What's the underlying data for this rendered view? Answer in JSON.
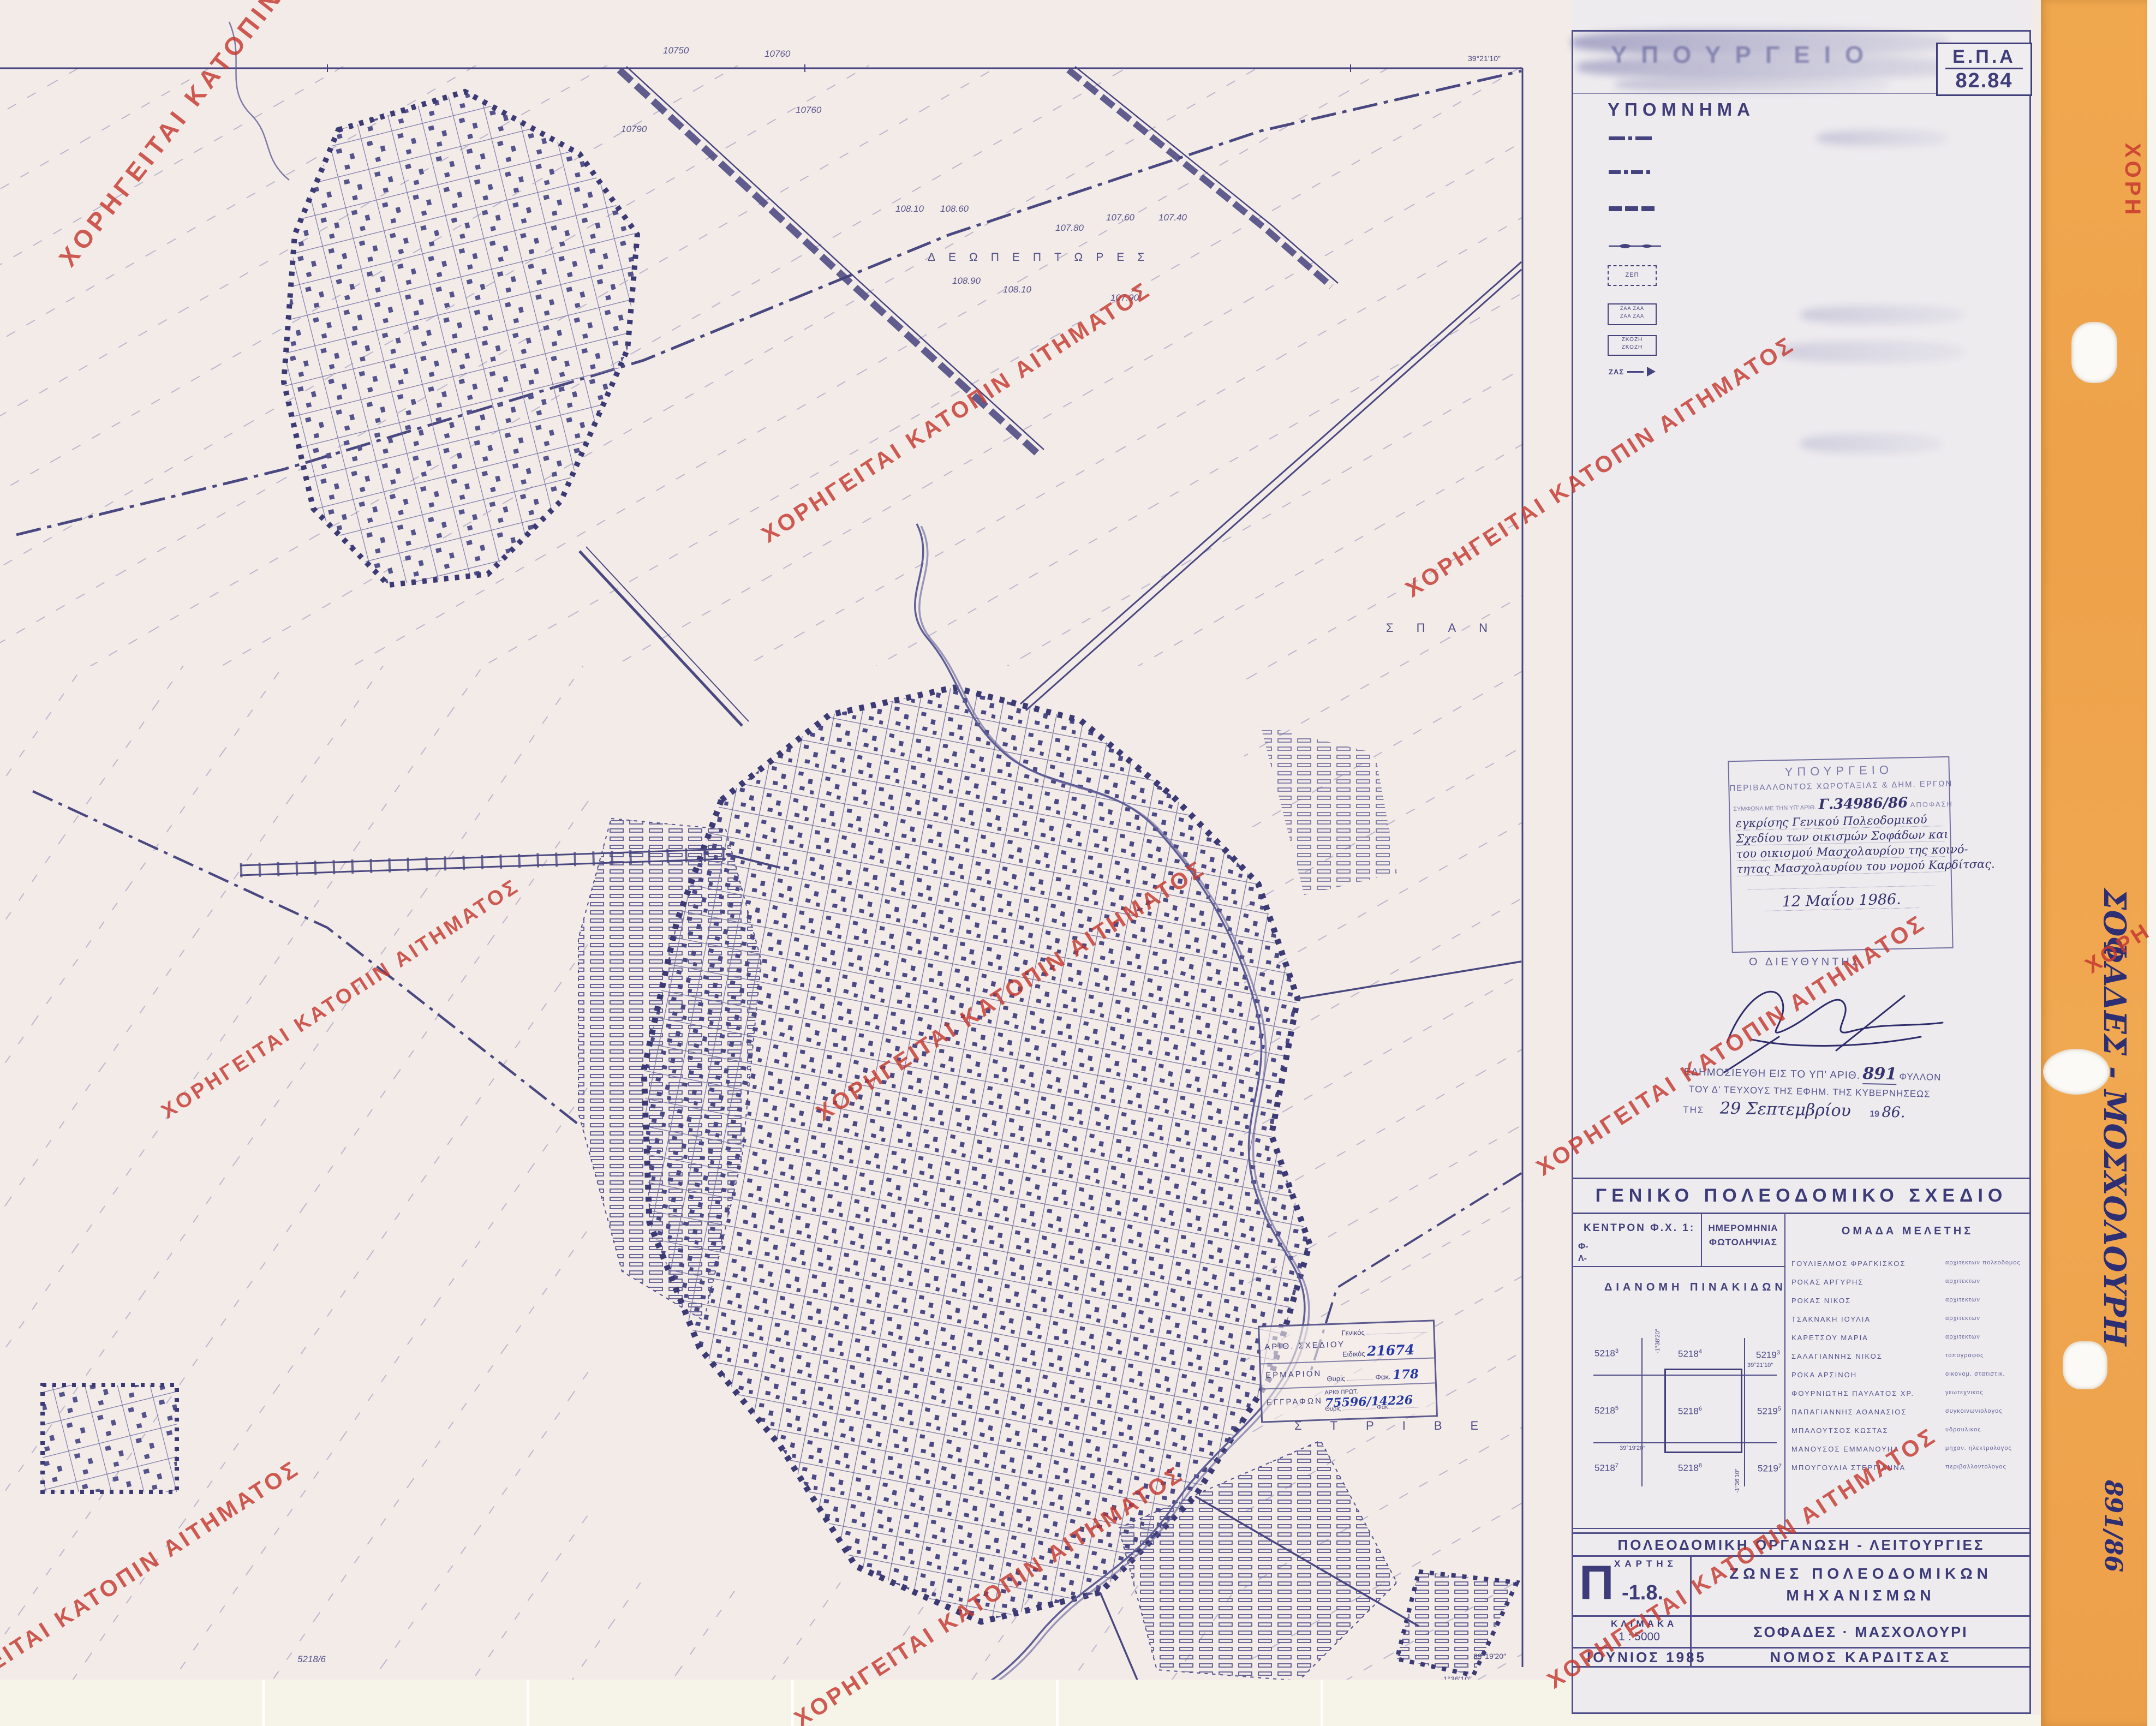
{
  "watermark": {
    "text": "ΧΟΡΗΓΕΙΤΑΙ ΚΑΤΟΠΙΝ ΑΙΤΗΜΑΤΟΣ",
    "fragment": "ΧΟΡΗ",
    "color": "#c23b34"
  },
  "header": {
    "ministry_ghost": "ΥΠΟΥΡΓΕΙΟ",
    "epa_label": "Ε.Π.Α",
    "epa_number": "82.84"
  },
  "legend": {
    "title": "ΥΠΟΜΝΗΜΑ",
    "items": [
      {
        "gr": "Ορια σχεδιου πολης 1987",
        "en": "Town-plan boundaries"
      },
      {
        "gr": "Ορια Δημων και Κοινοτητων",
        "en": "Municipality and community limits"
      },
      {
        "gr": "Ορια εγκεκριμμενου σχεδιου 1982",
        "en": "Town-plan limits 1982"
      },
      {
        "gr": "Ορια οικισμου προ του 23",
        "en": "Limits of pre-1923 settlement"
      },
      {
        "sym": "ΖΕΠ",
        "gr": "Ζωνες ενεργου πολεοδομιας",
        "en": "Zone of operational planning"
      },
      {
        "sym": "ΖΑΑ ΖΑΑ",
        "gr": "Ζωνες αστικου αναδασμου",
        "en": "Urban land adjustment zone"
      },
      {
        "sym": "ΖΚΟΖΗ",
        "gr": "Ζωνες κανονιστικων ορων δομησης",
        "en": "Zones of planning control"
      },
      {
        "sym": "ΖΑΣ",
        "gr": "Ζωνες αγορας συντελεστη",
        "en": "Zones of transfer development rights"
      }
    ]
  },
  "approval_stamp": {
    "ministry": "ΥΠΟΥΡΓΕΙΟ",
    "department": "ΠΕΡΙΒΑΛΛΟΝΤΟΣ ΧΩΡΟΤΑΞΙΑΣ & ΔΗΜ. ΕΡΓΩΝ",
    "ref_prefix": "ΣΥΜΦΩΝΑ ΜΕ ΤΗΝ ΥΠ' ΑΡΙΘ.",
    "ref_number": "Γ.34986/86",
    "ref_suffix": "ΑΠΟΦΑΣΗ",
    "hand_line1": "εγκρίσης Γενικού Πολεοδομικού",
    "hand_line2": "Σχεδίου των οικισμών Σοφάδων και",
    "hand_line3": "του οικισμού Μασχολαυρίου της κοινό-",
    "hand_line4": "τητας Μασχολαυρίου του νομού Καρδίτσας.",
    "date": "12 Μαΐου 1986.",
    "director": "Ο ΔΙΕΥΘΥΝΤΗΣ"
  },
  "publication": {
    "line1_prefix": "ΕΔΗΜΟΣΙΕΥΘΗ ΕΙΣ ΤΟ ΥΠ' ΑΡΙΘ.",
    "line1_number": "891",
    "line1_suffix": "ΦΥΛΛΟΝ",
    "line2": "ΤΟΥ Δ' ΤΕΥΧΟΥΣ ΤΗΣ ΕΦΗΜ. ΤΗΣ ΚΥΒΕΡΝΗΣΕΩΣ",
    "line3_prefix": "ΤΗΣ",
    "line3_date": "29 Σεπτεμβρίου",
    "line3_year_print": "19",
    "line3_year_hand": "86."
  },
  "gps_table": {
    "title": "ΓΕΝΙΚΟ ΠΟΛΕΟΔΟΜΙΚΟ ΣΧΕΔΙΟ",
    "kentron_label": "ΚΕΝΤΡΟΝ Φ.Χ. 1:",
    "f_label": "Φ-",
    "l_label": "Λ-",
    "date_col_line1": "ΗΜΕΡΟΜΗΝΙΑ",
    "date_col_line2": "ΦΩΤΟΛΗΨΙΑΣ",
    "team_col": "ΟΜΑΔΑ ΜΕΛΕΤΗΣ",
    "dianomi_label": "ΔΙΑΝΟΜΗ ΠΙΝΑΚΙΔΩΝ",
    "team": [
      {
        "name": "ΓΟΥΛΙΕΛΜΟΣ ΦΡΑΓΚΙΣΚΟΣ",
        "role": "αρχιτεκτων πολεοδομος"
      },
      {
        "name": "ΡΟΚΑΣ ΑΡΓΥΡΗΣ",
        "role": "αρχιτεκτων"
      },
      {
        "name": "ΡΟΚΑΣ ΝΙΚΟΣ",
        "role": "αρχιτεκτων"
      },
      {
        "name": "ΤΣΑΚΝΑΚΗ ΙΟΥΛΙΑ",
        "role": "αρχιτεκτων"
      },
      {
        "name": "ΚΑΡΕΤΣΟΥ ΜΑΡΙΑ",
        "role": "αρχιτεκτων"
      },
      {
        "name": "ΣΑΛΑΓΙΑΝΝΗΣ ΝΙΚΟΣ",
        "role": "τοπογραφος"
      },
      {
        "name": "ΡΟΚΑ ΑΡΣΙΝΟΗ",
        "role": "οικονομ. στατιστικ."
      },
      {
        "name": "ΦΟΥΡΝΙΩΤΗΣ ΠΑΥΛΑΤΟΣ ΧΡ.",
        "role": "γεωτεχνικος"
      },
      {
        "name": "ΠΑΠΑΓΙΑΝΝΗΣ ΑΘΑΝΑΣΙΟΣ",
        "role": "συγκοινωνιολογος"
      },
      {
        "name": "ΜΠΑΛΟΥΤΣΟΣ ΚΩΣΤΑΣ",
        "role": "υδραυλικος"
      },
      {
        "name": "ΜΑΝΟΥΣΟΣ ΕΜΜΑΝΟΥΗΛ",
        "role": "μηχαν. ηλεκτρολογος"
      },
      {
        "name": "ΜΠΟΥΓΟΥΛΙΑ ΣΤΕΡΓΙΑΝΝΑ",
        "role": "περιβαλλοντολογος"
      }
    ],
    "grid": {
      "cells": [
        {
          "b": "5218",
          "s": "3"
        },
        {
          "b": "5218",
          "s": "4"
        },
        {
          "b": "5219",
          "s": "3"
        },
        {
          "b": "5218",
          "s": "5"
        },
        {
          "b": "5218",
          "s": "6"
        },
        {
          "b": "5219",
          "s": "5"
        },
        {
          "b": "5218",
          "s": "7"
        },
        {
          "b": "5218",
          "s": "8"
        },
        {
          "b": "5219",
          "s": "7"
        }
      ],
      "coord_left": "-1°38'20″",
      "coord_top": "39°21'10″",
      "coord_bottom": "39°19'20″",
      "coord_right": "-1°36'10″"
    }
  },
  "title_block": {
    "row1": "ΠΟΛΕΟΔΟΜΙΚΗ ΟΡΓΑΝΩΣΗ - ΛΕΙΤΟΥΡΓΙΕΣ",
    "map_label": "ΧΑΡΤΗΣ",
    "code_letter": "Π",
    "code_suffix": "-1.8.",
    "subject1": "ΖΩΝΕΣ ΠΟΛΕΟΔΟΜΙΚΩΝ",
    "subject2": "ΜΗΧΑΝΙΣΜΩΝ",
    "scale_label": "ΚΛΙΜΑΚΑ",
    "scale_value": "1 : 5000",
    "area": "ΣΟΦΑΔΕΣ · ΜΑΣΧΟΛΟΥΡΙ",
    "date": "ΙΟΥΝΙΟΣ 1985",
    "prefecture": "ΝΟΜΟΣ ΚΑΡΔΙΤΣΑΣ"
  },
  "registry_stamp": {
    "row1_label": "ΑΡΙΘ. ΣΧΕΔΙΟΥ",
    "generic_label": "Γενικός",
    "specific_label": "Ειδικός",
    "specific_value": "21674",
    "row2_label": "ΕΡΜΑΡΙΟΝ",
    "thyris_label": "Θυρίς",
    "fak_label": "Φακ.",
    "fak_value": "178",
    "row3_label": "ΕΓΓΡΑΦΩΝ",
    "prot_label": "ΑΡΙΘ ΠΡΩΤ.",
    "prot_value": "75596/14226"
  },
  "map": {
    "coord_top_right": "39°21'10″",
    "coord_bottom_lat": "39°19'20″",
    "coord_bottom_lon": "-1°36'10″",
    "place1": "ΔΕΩΠΕΠΤΩΡΕΣ",
    "place2": "ΣΠΑΝ",
    "place3": "ΣΤΡΙΒΕ",
    "labels": [
      "10750",
      "10760",
      "10760",
      "10790",
      "108.10",
      "108.60",
      "107.80",
      "107.60",
      "107.40",
      "108.90",
      "108.10",
      "107.90",
      "5218/6"
    ]
  },
  "strip": {
    "title": "ΣΟΦΑΔΕΣ - ΜΟΣΧΟΛΟΥΡΗ",
    "number": "891/86",
    "color": "#efa64f"
  }
}
